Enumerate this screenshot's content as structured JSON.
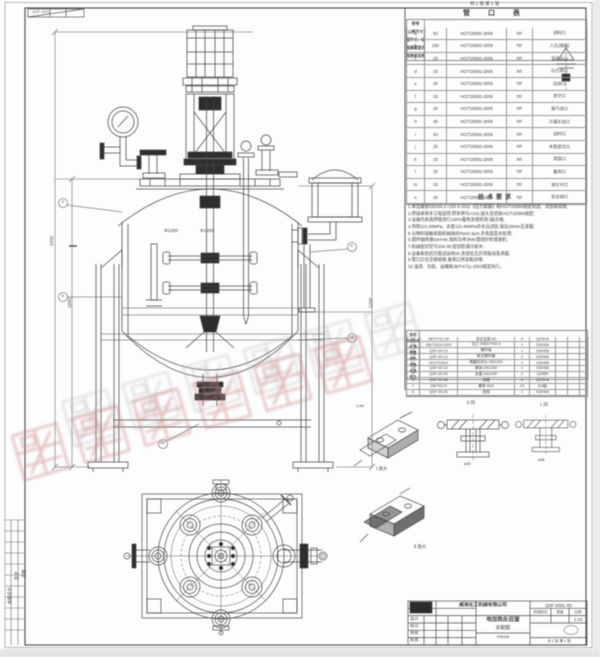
{
  "sheet": {
    "top_note": "共 1 张  第 1 张",
    "corner_code": "QSF-500L"
  },
  "watermark": {
    "text": "威海化工机械",
    "color": "#c97f7f"
  },
  "nozzle_table": {
    "title": "管 口 表",
    "headers": [
      "符号",
      "公称尺寸",
      "连接尺寸、标准",
      "连接面型式",
      "用途或名称"
    ],
    "rows": [
      [
        "a",
        "50",
        "HG/T20592-2009",
        "RF",
        "进料口"
      ],
      [
        "b",
        "150",
        "HG/T20592-2009",
        "RF",
        "人孔(视镜)"
      ],
      [
        "c",
        "25",
        "HG/T20592-2009",
        "RF",
        "温度计口"
      ],
      [
        "d",
        "25",
        "HG/T20592-2009",
        "RF",
        "压力表口"
      ],
      [
        "e",
        "40",
        "HG/T20592-2009",
        "RF",
        "回流口"
      ],
      [
        "f",
        "25",
        "HG/T20592-2009",
        "RF",
        "放空口"
      ],
      [
        "g",
        "40",
        "HG/T20592-2009",
        "RF",
        "蒸汽进口"
      ],
      [
        "h",
        "40",
        "HG/T20592-2009",
        "RF",
        "冷凝水出口"
      ],
      [
        "i",
        "50",
        "HG/T20592-2009",
        "RF",
        "出料口"
      ],
      [
        "j",
        "25",
        "HG/T20592-2009",
        "RF",
        "夹套放空口"
      ],
      [
        "k",
        "25",
        "HG/T20592-2009",
        "RF",
        "测温口"
      ],
      [
        "l",
        "32",
        "HG/T20592-2009",
        "RF",
        "备用口"
      ],
      [
        "m",
        "25",
        "HG/T20592-2009",
        "RF",
        "液位计口"
      ],
      [
        "n",
        "40",
        "HG/T20592-2009",
        "RF",
        "安全阀口"
      ]
    ]
  },
  "tech_requirements": {
    "title": "技术要求",
    "items": [
      "1.本设备按GB150.1~150.4-2011《压力容器》和HG/T20569规定制造、试验和验收;",
      "2.焊接采用手工电弧焊,焊条牌号A102,接头型式按HG/T20583规定;",
      "3.设备内表面焊缝进行100%着色渗透检测,Ⅰ级合格;",
      "4.内筒以0.30MPa、夹套以0.45MPa作水压试验,保压30min无渗漏;",
      "5.与物料接触表面机械抛光Ra≤0.4μm,外表面亚光处理;",
      "6.搅拌轴转速63r/min,电机功率3kW,摆线针轮减速机;",
      "7.机械密封型号204-35,密封腔通冷却水;",
      "8.设备安装后空载试运转2h,各部位无异常振动及渗漏;",
      "9.管口方位见俯视图,备用口用盲板封堵;",
      "10.油漆、包装、运输按JB/T4711-2003规定执行。"
    ]
  },
  "bom_table": {
    "headers": [
      "件号",
      "代号或标准号",
      "名  称",
      "数量",
      "材料",
      "单重",
      "总重",
      "备注"
    ],
    "rows": [
      [
        "15",
        "JB/T4712-92",
        "耳式支座 B3",
        "4",
        "Q235-B",
        "",
        "",
        ""
      ],
      [
        "14",
        "GB/T9119-2010",
        "法兰 DN50 PN1.6",
        "1",
        "S30408",
        "",
        "",
        ""
      ],
      [
        "13",
        "QSF-00-13",
        "搅拌轴",
        "1",
        "S30408",
        "",
        "",
        ""
      ],
      [
        "12",
        "QSF-00-12",
        "桨式搅拌器",
        "2",
        "S30408",
        "",
        "",
        ""
      ],
      [
        "11",
        "HG/T21514",
        "椭圆形封头 DN1200",
        "1",
        "S30408",
        "",
        "",
        ""
      ],
      [
        "10",
        "QSF-00-10",
        "筒体 DN1200",
        "1",
        "S30408",
        "",
        "",
        ""
      ],
      [
        "9",
        "QSF-00-09",
        "夹套 DN1300",
        "1",
        "Q345R",
        "",
        "",
        ""
      ],
      [
        "8",
        "QSF-00-08",
        "支腿",
        "4",
        "Q235-B",
        "",
        "",
        ""
      ],
      [
        "7",
        "GB/T6170",
        "螺母 M16",
        "24",
        "8.8级",
        "",
        "",
        ""
      ],
      [
        "6",
        "QSF-00-06",
        "底阀",
        "1",
        "S30408",
        "",
        "",
        ""
      ]
    ]
  },
  "dimensions": {
    "overall_height": "2450",
    "vessel_height": "1850",
    "right_height": "1200",
    "inner_dia": "Φ1200",
    "jacket_dia": "Φ1300"
  },
  "details": {
    "captions": [
      "Ⅰ 放大",
      "b 向",
      "c 向",
      "Ⅱ 放大"
    ],
    "notes": [
      "2-ø9",
      "ø45",
      "ø36"
    ]
  },
  "balloons": [
    "3",
    "5",
    "9",
    "12",
    "15"
  ],
  "margin_labels": [
    "底图总号",
    "签字",
    "日期"
  ],
  "title_block": {
    "company": "威海化工机械有限公司",
    "drawing_no": "QSF-500L-00",
    "drawing_title_1": "电加热反应釜",
    "drawing_title_2": "装配图",
    "material": "S30408",
    "stage_label": "阶段标记",
    "mass_label": "质量",
    "scale_label": "比例",
    "scale_value": "1:10",
    "sheets_note": "共 1 张  第 1 张",
    "rows_left": [
      "设计",
      "校对",
      "审核",
      "批准"
    ]
  }
}
